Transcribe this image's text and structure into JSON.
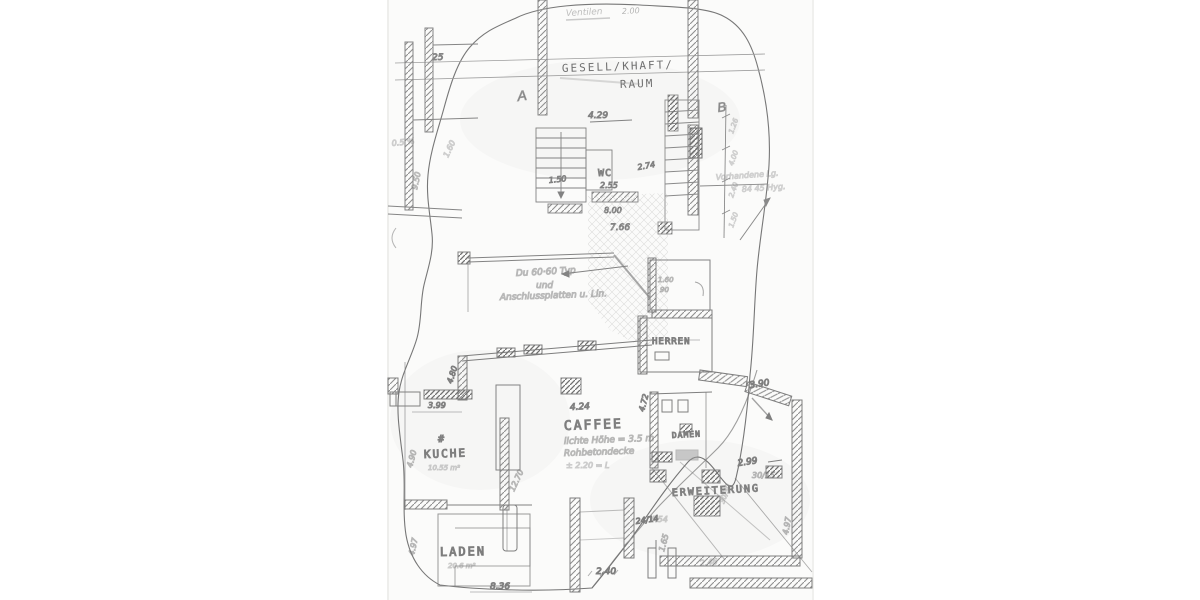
{
  "document": {
    "kind": "scanned hand-drawn architectural floor plan"
  },
  "colors": {
    "paper": "#fbfbfa",
    "pencil": "#6f6f6f",
    "wall": "#7d7d7d",
    "light": "#b9b9b9"
  },
  "labels": {
    "gesellschaftsraum1": "GESELL/KHAFT/",
    "gesellschaftsraum2": "RAUM",
    "wc": "WC",
    "herren": "HERREN",
    "damen": "DAMEN",
    "caffee": "CAFFEE",
    "kueche": "KUCHE",
    "kueche_hash": "#",
    "laden": "LADEN",
    "erweiterung": "ERWEITERUNG",
    "section_a": "A",
    "section_b": "B"
  },
  "notes": {
    "top": "Ventilen",
    "mid1": "Du 60·60 Typ",
    "mid2": "und",
    "mid3": "Anschlussplatten u. Lin.",
    "caffee1": "lichte Höhe = 3.5 m",
    "caffee2": "Rohbetondecke",
    "caffee3": "± 2.20 = L",
    "kueche_area": "10.55 m²",
    "laden_area": "20.6 m²",
    "right1": "Vorhandene Lg.",
    "right2": "84 45 Hyg.",
    "left1": "0.5 %",
    "left2": "1.60"
  },
  "dims": {
    "top_width": "2.00",
    "d25": "25",
    "d429": "4.29",
    "d150": "1.50",
    "d255": "2.55",
    "d274": "2.74",
    "d800": "8.00",
    "d766": "7.66",
    "d950": "9.50",
    "d480": "4.80",
    "d399": "3.99",
    "d424": "4.24",
    "d472": "4.72",
    "d490": "4.90",
    "d1270": "12.70",
    "d390": "3.90",
    "d299": "2.99",
    "d3015": "30/15",
    "d2414": "24/14",
    "d240": "2.40",
    "d165": "1.65",
    "d836": "8.36",
    "d497a": "4.97",
    "d497b": "4.97",
    "d160": "1.60",
    "d90": "90",
    "d246": "2.46",
    "d454": "4.54",
    "d3030": "30/30",
    "chain1": "1.26",
    "chain2": "4.00",
    "chain3": "2.40",
    "chain4": "1.50"
  }
}
